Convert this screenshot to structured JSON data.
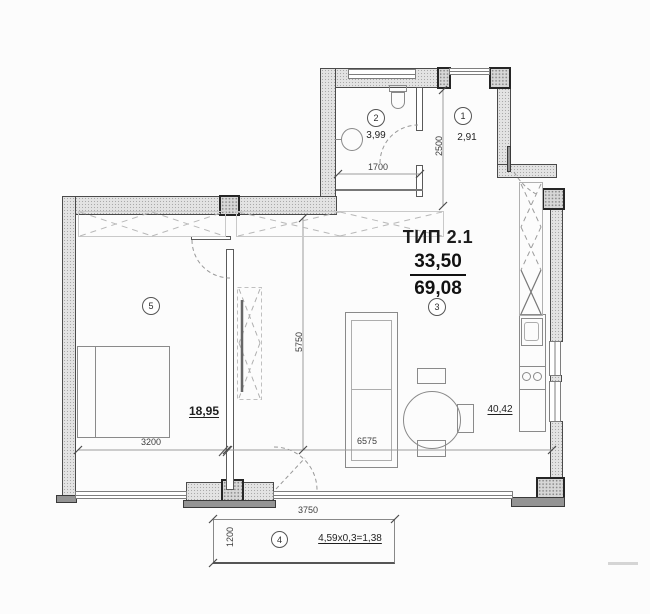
{
  "plan": {
    "type_label": "ТИП 2.1",
    "area_primary": "33,50",
    "area_total": "69,08"
  },
  "rooms": {
    "r1": {
      "num": "1",
      "area": "2,91"
    },
    "r2": {
      "num": "2",
      "area": "3,99"
    },
    "r3": {
      "num": "3",
      "area": "40,42"
    },
    "r4": {
      "num": "4",
      "area": "4,59x0,3=1,38"
    },
    "r5": {
      "num": "5",
      "area": "18,95"
    }
  },
  "dims": {
    "bath_width": "1700",
    "hall_depth": "2500",
    "bedroom_width": "3200",
    "room_depth": "5750",
    "sofa_wall": "6575",
    "balcony_width": "3750",
    "balcony_depth": "1200"
  },
  "colors": {
    "wall_fill": "#e3e3e3",
    "wall_edge": "#4a4a4a",
    "line": "#8a8a8a",
    "text": "#1f1f1f"
  }
}
